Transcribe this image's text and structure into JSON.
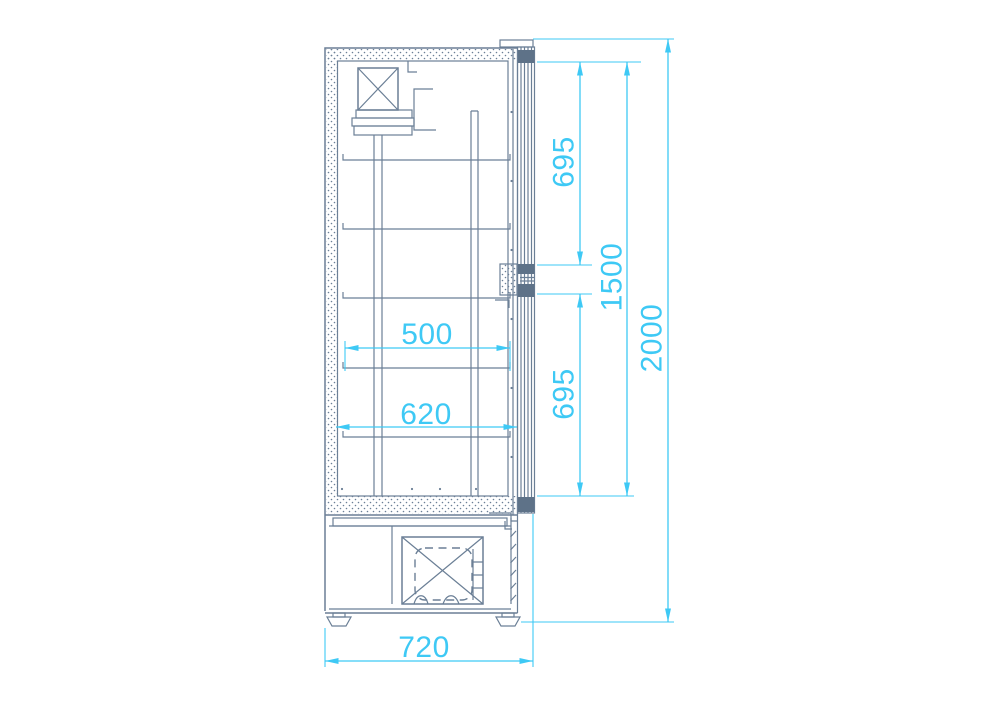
{
  "diagram": {
    "type": "technical-drawing",
    "view": "side-section",
    "subject": "upright glass-door refrigerated cabinet",
    "units": "mm",
    "colors": {
      "line": "#6B7F96",
      "hinge_fill": "#5E7288",
      "dimension": "#3EC9F5",
      "background": "#FFFFFF"
    },
    "dimensions": {
      "upper_door_section": "695",
      "door_glass_height": "1500",
      "lower_door_section": "695",
      "overall_height": "2000",
      "shelf_depth": "500",
      "interior_depth": "620",
      "overall_depth": "720"
    }
  }
}
